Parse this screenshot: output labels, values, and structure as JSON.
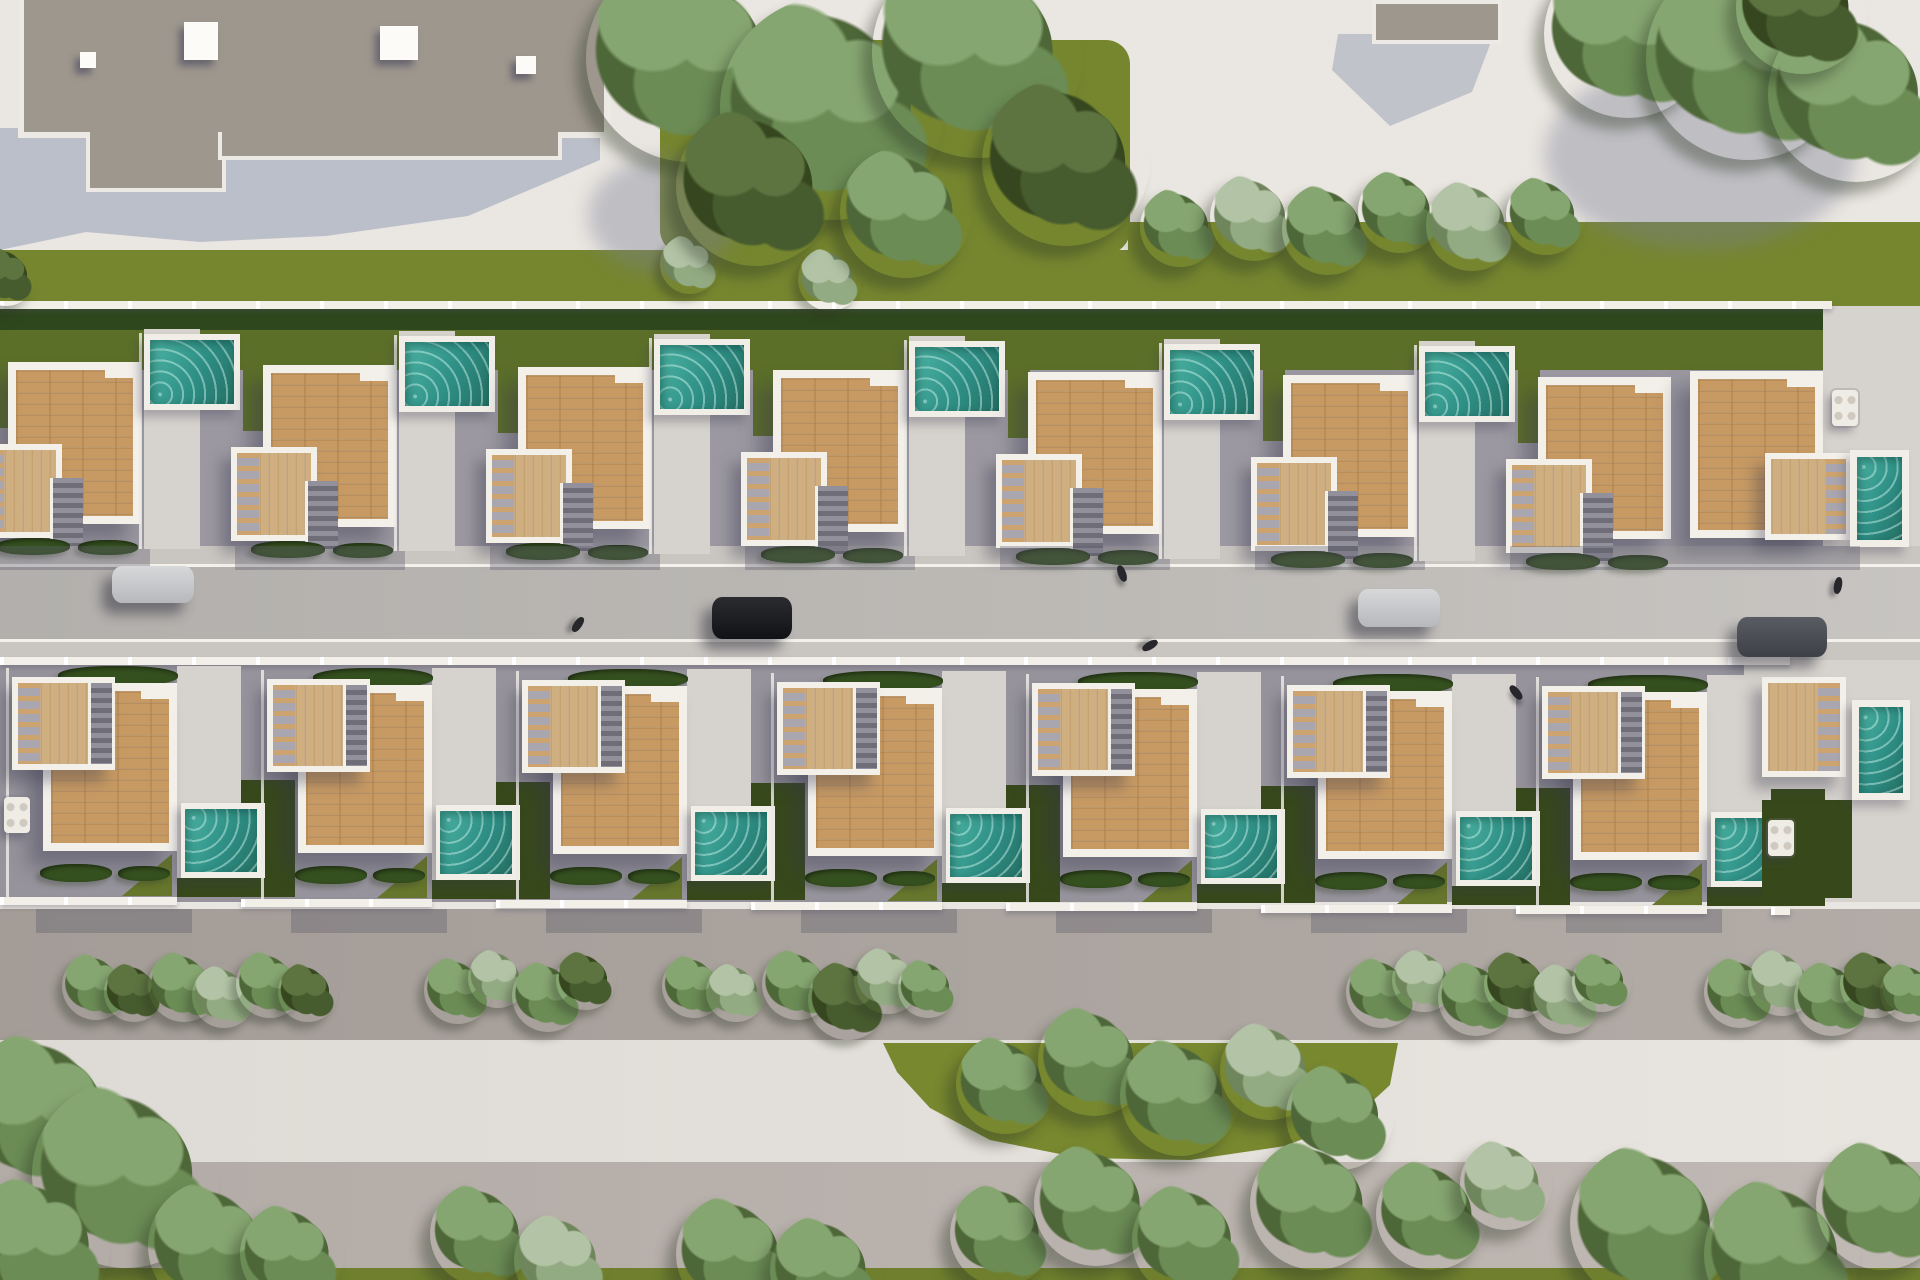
{
  "meta": {
    "description": "Aerial top-down 3D architectural rendering of a residential development: two rows of white villas with wooden roof decks and private teal pools facing a central street with parked cars, bordered by lawns, hedges, bushes and trees, a large flat-roof building at top-left and pedestrian promenades at the bottom",
    "width": 1920,
    "height": 1280
  },
  "palette": {
    "plaza": "#eae6e1",
    "grass": "#76862f",
    "grass_dark": "#5c6f29",
    "lawn_light": "#66762c",
    "hedge": "#2f471c",
    "patio": "#9b98a1",
    "patio_b": "#96939c",
    "light": "#d6d2cd",
    "curb": "#f4f1eb",
    "street": "#b8b5b2",
    "walk_top": "#c9c5c1",
    "walk_low": "#aba49f",
    "road_light": "#e3dfda",
    "band_low": "#bab2ad",
    "grass_low": "#6f7f2d",
    "roof_main": "#9e978e",
    "roof_edge": "#edeae5",
    "shadow_blue": "#b6bac6",
    "wood": "#c79a63",
    "wood_pale": "#cfae7f",
    "pool_light": "#4cb4a4",
    "pool_mid": "#2e8f85",
    "pool_deep": "#257065",
    "white": "#f3f0ea",
    "garden_dark": "#37491b",
    "patch": "#78882f",
    "car_silver": "#c9cacc",
    "car_black": "#1a1c1f",
    "car_gray": "#4b4e53"
  },
  "bands": [
    [
      "plaza-top",
      0,
      0,
      1920,
      252,
      "plaza"
    ],
    [
      "grass-center-top",
      660,
      40,
      470,
      214,
      "grass"
    ],
    [
      "grass-strip-right",
      1128,
      222,
      792,
      34,
      "grass"
    ],
    [
      "grass-band",
      0,
      250,
      1920,
      56,
      "grass"
    ],
    [
      "patio-top",
      0,
      304,
      1832,
      242,
      "patio"
    ],
    [
      "hedge-back",
      0,
      306,
      1832,
      26,
      "hedge"
    ],
    [
      "grass-top-row",
      0,
      330,
      1832,
      40,
      "grass_dark"
    ],
    [
      "corner-deck-top",
      1823,
      306,
      97,
      240,
      "light"
    ],
    [
      "walk-top",
      0,
      546,
      1920,
      20,
      "walk_top"
    ],
    [
      "curb-top",
      0,
      564,
      1920,
      4,
      "curb"
    ],
    [
      "street",
      0,
      567,
      1920,
      74,
      "street"
    ],
    [
      "curb-low",
      0,
      639,
      1920,
      4,
      "curb"
    ],
    [
      "walk-street-low",
      0,
      642,
      1920,
      18,
      "walk_top"
    ],
    [
      "patio-bottom",
      0,
      660,
      1790,
      242,
      "patio_b"
    ],
    [
      "light-bottom-right",
      1744,
      660,
      176,
      242,
      "light"
    ],
    [
      "walk-low",
      0,
      909,
      1920,
      131,
      "walk_low"
    ],
    [
      "road-light",
      0,
      1040,
      1920,
      124,
      "road_light"
    ],
    [
      "band-low",
      0,
      1162,
      1920,
      112,
      "band_low"
    ],
    [
      "grass-bottom",
      0,
      1268,
      1920,
      12,
      "grass_low"
    ]
  ],
  "green_patch": [
    [
      883,
      1043
    ],
    [
      1398,
      1043
    ],
    [
      1390,
      1085
    ],
    [
      1352,
      1120
    ],
    [
      1285,
      1146
    ],
    [
      1190,
      1160
    ],
    [
      1080,
      1158
    ],
    [
      990,
      1140
    ],
    [
      930,
      1108
    ],
    [
      897,
      1072
    ]
  ],
  "buildings": {
    "main": {
      "roof": [
        18,
        0,
        580,
        132
      ],
      "wings": [
        [
          86,
          132,
          132,
          56
        ],
        [
          218,
          132,
          336,
          24
        ]
      ],
      "vents": [
        [
          80,
          52,
          16,
          16
        ],
        [
          184,
          22,
          34,
          38
        ],
        [
          380,
          26,
          38,
          34
        ],
        [
          516,
          56,
          20,
          18
        ]
      ],
      "shadow": [
        [
          14,
          128
        ],
        [
          600,
          128
        ],
        [
          600,
          160
        ],
        [
          468,
          216
        ],
        [
          326,
          236
        ],
        [
          200,
          242
        ],
        [
          86,
          232
        ],
        [
          0,
          250
        ],
        [
          0,
          128
        ]
      ]
    },
    "small": {
      "roof": [
        1372,
        0,
        122,
        36
      ],
      "shadow": [
        [
          1338,
          34
        ],
        [
          1494,
          34
        ],
        [
          1472,
          92
        ],
        [
          1390,
          126
        ],
        [
          1332,
          70
        ]
      ]
    }
  },
  "plaza_shadows": [
    [
      1545,
      60,
      310,
      190
    ],
    [
      588,
      158,
      150,
      115
    ]
  ],
  "top_row": {
    "roof_xs": [
      8,
      263,
      518,
      773,
      1028,
      1283,
      1538
    ],
    "corner": {
      "roof": [
        1690,
        371,
        133,
        167
      ],
      "deck": [
        1765,
        453,
        87,
        87
      ],
      "pool": [
        1857,
        457,
        45,
        83
      ]
    }
  },
  "bottom_row": {
    "unit_xs": [
      0,
      255,
      510,
      765,
      1020,
      1275,
      1530
    ],
    "corner": {
      "deck": [
        1762,
        677,
        84,
        100
      ],
      "pool": [
        1859,
        707,
        44,
        86
      ],
      "garden": [
        1762,
        800,
        90,
        98
      ]
    }
  },
  "fences": {
    "top_back": [
      0,
      301,
      1832,
      8
    ],
    "bottom_back": [
      0,
      657,
      1790,
      8
    ],
    "front_y": 897,
    "front_end": 1790
  },
  "cars": [
    {
      "x": 112,
      "y": 566,
      "w": 82,
      "h": 37,
      "color": "silver"
    },
    {
      "x": 712,
      "y": 597,
      "w": 80,
      "h": 42,
      "color": "black"
    },
    {
      "x": 1358,
      "y": 589,
      "w": 82,
      "h": 38,
      "color": "silver"
    },
    {
      "x": 1737,
      "y": 617,
      "w": 90,
      "h": 40,
      "color": "gray"
    }
  ],
  "people": [
    [
      574,
      616,
      35
    ],
    [
      1118,
      565,
      -20
    ],
    [
      1146,
      637,
      60
    ],
    [
      1834,
      577,
      10
    ],
    [
      1512,
      684,
      -40
    ]
  ],
  "tables": [
    [
      1832,
      390
    ],
    [
      4,
      797
    ],
    [
      1768,
      820
    ]
  ],
  "trees": [
    [
      690,
      58,
      104,
      "g"
    ],
    [
      832,
      108,
      112,
      "g"
    ],
    [
      978,
      52,
      106,
      "g"
    ],
    [
      1066,
      162,
      84,
      "d"
    ],
    [
      756,
      186,
      80,
      "d"
    ],
    [
      906,
      212,
      66,
      "g"
    ],
    [
      1628,
      34,
      84,
      "g"
    ],
    [
      1748,
      58,
      102,
      "g"
    ],
    [
      1856,
      94,
      88,
      "g"
    ],
    [
      1802,
      8,
      66,
      "d"
    ],
    [
      1180,
      227,
      40,
      "g"
    ],
    [
      1254,
      217,
      44,
      "p"
    ],
    [
      1328,
      229,
      46,
      "g"
    ],
    [
      1400,
      211,
      42,
      "g"
    ],
    [
      1472,
      225,
      46,
      "p"
    ],
    [
      1546,
      215,
      40,
      "g"
    ],
    [
      6,
      276,
      30,
      "d"
    ],
    [
      1006,
      1084,
      50,
      "g"
    ],
    [
      1094,
      1060,
      56,
      "g"
    ],
    [
      1180,
      1096,
      60,
      "g"
    ],
    [
      1270,
      1070,
      50,
      "p"
    ],
    [
      1340,
      1116,
      54,
      "g"
    ],
    [
      44,
      1114,
      84,
      "g"
    ],
    [
      126,
      1174,
      94,
      "g"
    ],
    [
      38,
      1246,
      72,
      "g"
    ],
    [
      214,
      1246,
      66,
      "g"
    ],
    [
      292,
      1254,
      52,
      "g"
    ],
    [
      482,
      1234,
      52,
      "g"
    ],
    [
      562,
      1260,
      48,
      "p"
    ],
    [
      736,
      1254,
      60,
      "g"
    ],
    [
      826,
      1270,
      56,
      "g"
    ],
    [
      1002,
      1234,
      52,
      "g"
    ],
    [
      1096,
      1204,
      62,
      "g"
    ],
    [
      1190,
      1240,
      58,
      "g"
    ],
    [
      1316,
      1204,
      66,
      "g"
    ],
    [
      1432,
      1214,
      56,
      "g"
    ],
    [
      1506,
      1184,
      46,
      "p"
    ],
    [
      1652,
      1224,
      82,
      "g"
    ],
    [
      1782,
      1254,
      78,
      "g"
    ],
    [
      1882,
      1204,
      66,
      "g"
    ]
  ],
  "bushes": [
    [
      660,
      234,
      30,
      "p"
    ],
    [
      798,
      247,
      32,
      "p"
    ],
    [
      62,
      952,
      34,
      "g"
    ],
    [
      104,
      962,
      30,
      "d"
    ],
    [
      148,
      950,
      36,
      "g"
    ],
    [
      192,
      964,
      32,
      "p"
    ],
    [
      236,
      950,
      34,
      "g"
    ],
    [
      278,
      962,
      30,
      "d"
    ],
    [
      424,
      956,
      34,
      "g"
    ],
    [
      468,
      948,
      30,
      "p"
    ],
    [
      512,
      960,
      36,
      "g"
    ],
    [
      556,
      950,
      30,
      "d"
    ],
    [
      662,
      954,
      32,
      "g"
    ],
    [
      706,
      962,
      30,
      "p"
    ],
    [
      762,
      948,
      36,
      "g"
    ],
    [
      808,
      960,
      40,
      "d"
    ],
    [
      854,
      946,
      34,
      "p"
    ],
    [
      898,
      958,
      30,
      "g"
    ],
    [
      1346,
      956,
      36,
      "g"
    ],
    [
      1392,
      948,
      32,
      "p"
    ],
    [
      1438,
      960,
      38,
      "g"
    ],
    [
      1484,
      950,
      34,
      "d"
    ],
    [
      1530,
      962,
      36,
      "p"
    ],
    [
      1572,
      952,
      30,
      "g"
    ],
    [
      1704,
      956,
      36,
      "g"
    ],
    [
      1748,
      948,
      34,
      "p"
    ],
    [
      1794,
      960,
      38,
      "g"
    ],
    [
      1840,
      950,
      34,
      "d"
    ],
    [
      1880,
      962,
      30,
      "g"
    ]
  ]
}
